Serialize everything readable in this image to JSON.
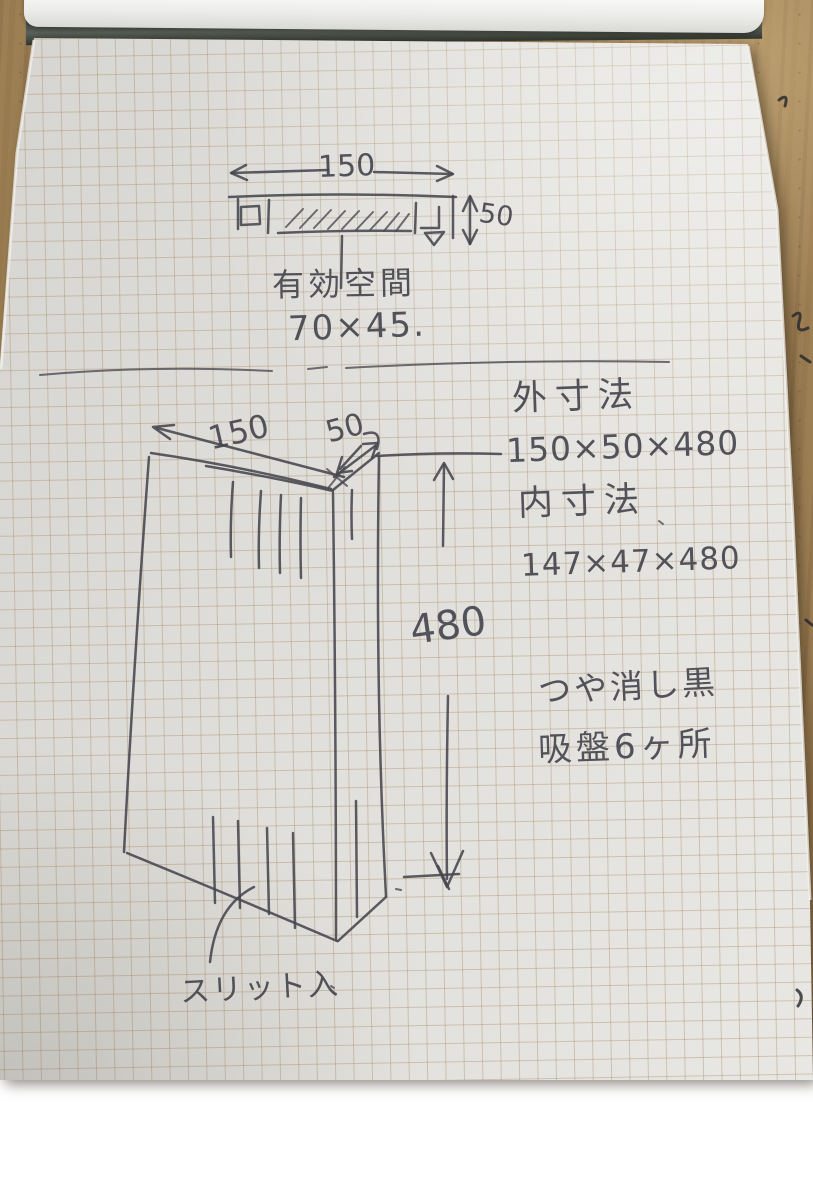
{
  "scene": {
    "description": "Hand-drawn dimensioned sketch of a slim channel part on grid notepad, photographed on a wooden table",
    "ink_color": "#45454d",
    "paper_color": "#e0dfdb",
    "grid_color": "#a28862",
    "wood_color": "#9d7f54",
    "binding_color": "#4a514a",
    "page_curl_color": "#f2f2f0"
  },
  "top_view": {
    "width_dim": "150",
    "height_dim": "50",
    "caption_title": "有効空間",
    "caption_size": "70×45."
  },
  "notes": {
    "outer_label": "外寸法",
    "outer_dims": "150×50×480",
    "inner_label": "内寸法",
    "inner_dims": "147×47×480",
    "finish_note": "つや消し黒",
    "suction_note": "吸盤6ヶ所"
  },
  "side_view": {
    "width_dim": "150",
    "depth_dim": "50",
    "height_dim": "480",
    "slit_note": "スリット入"
  }
}
